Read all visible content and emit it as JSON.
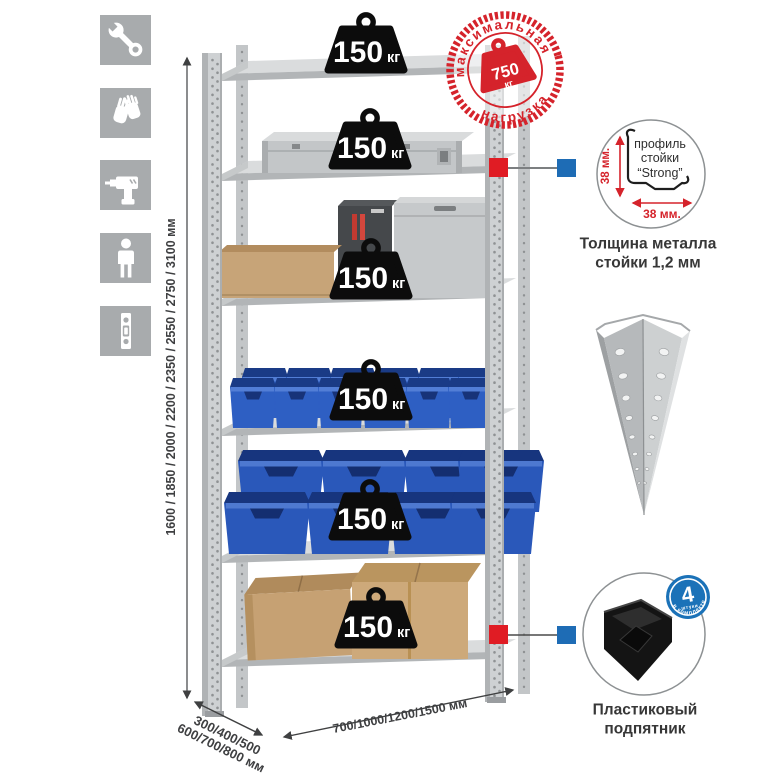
{
  "icons": {
    "items": [
      {
        "name": "wrench"
      },
      {
        "name": "gloves"
      },
      {
        "name": "drill"
      },
      {
        "name": "person"
      },
      {
        "name": "upright-post"
      }
    ]
  },
  "rack": {
    "shelf_count": 6,
    "shelf_load_badge": {
      "value": "150",
      "unit": "кг"
    }
  },
  "max_load_stamp": {
    "arc_top": "максимальная",
    "arc_bottom": "нагрузка",
    "value": "750",
    "unit": "кг"
  },
  "profile_detail": {
    "line1": "профиль",
    "line2": "стойки",
    "line3": "“Strong”",
    "dim_vertical": "38 мм.",
    "dim_horizontal": "38 мм.",
    "caption_line1": "Толщина металла",
    "caption_line2": "стойки 1,2 мм"
  },
  "foot_detail": {
    "badge_value": "4",
    "badge_small": "штуки",
    "badge_arc": "в комплекте",
    "caption_line1": "Пластиковый",
    "caption_line2": "подпятник"
  },
  "dimensions": {
    "height": "1600 / 1850 / 2000 / 2200 / 2350 / 2550 / 2750 / 3100 мм",
    "depth_line1": "300/400/500",
    "depth_line2": "600/700/800 мм",
    "width": "700/1000/1200/1500 мм"
  },
  "colors": {
    "stamp_red": "#d5232b",
    "marker_red": "#e01c24",
    "marker_blue": "#1e6cb5",
    "icon_bg": "#a8abad",
    "metal_light": "#d5d8d9",
    "bin_blue": "#2e5fc3",
    "text_dark": "#3e3f41"
  }
}
